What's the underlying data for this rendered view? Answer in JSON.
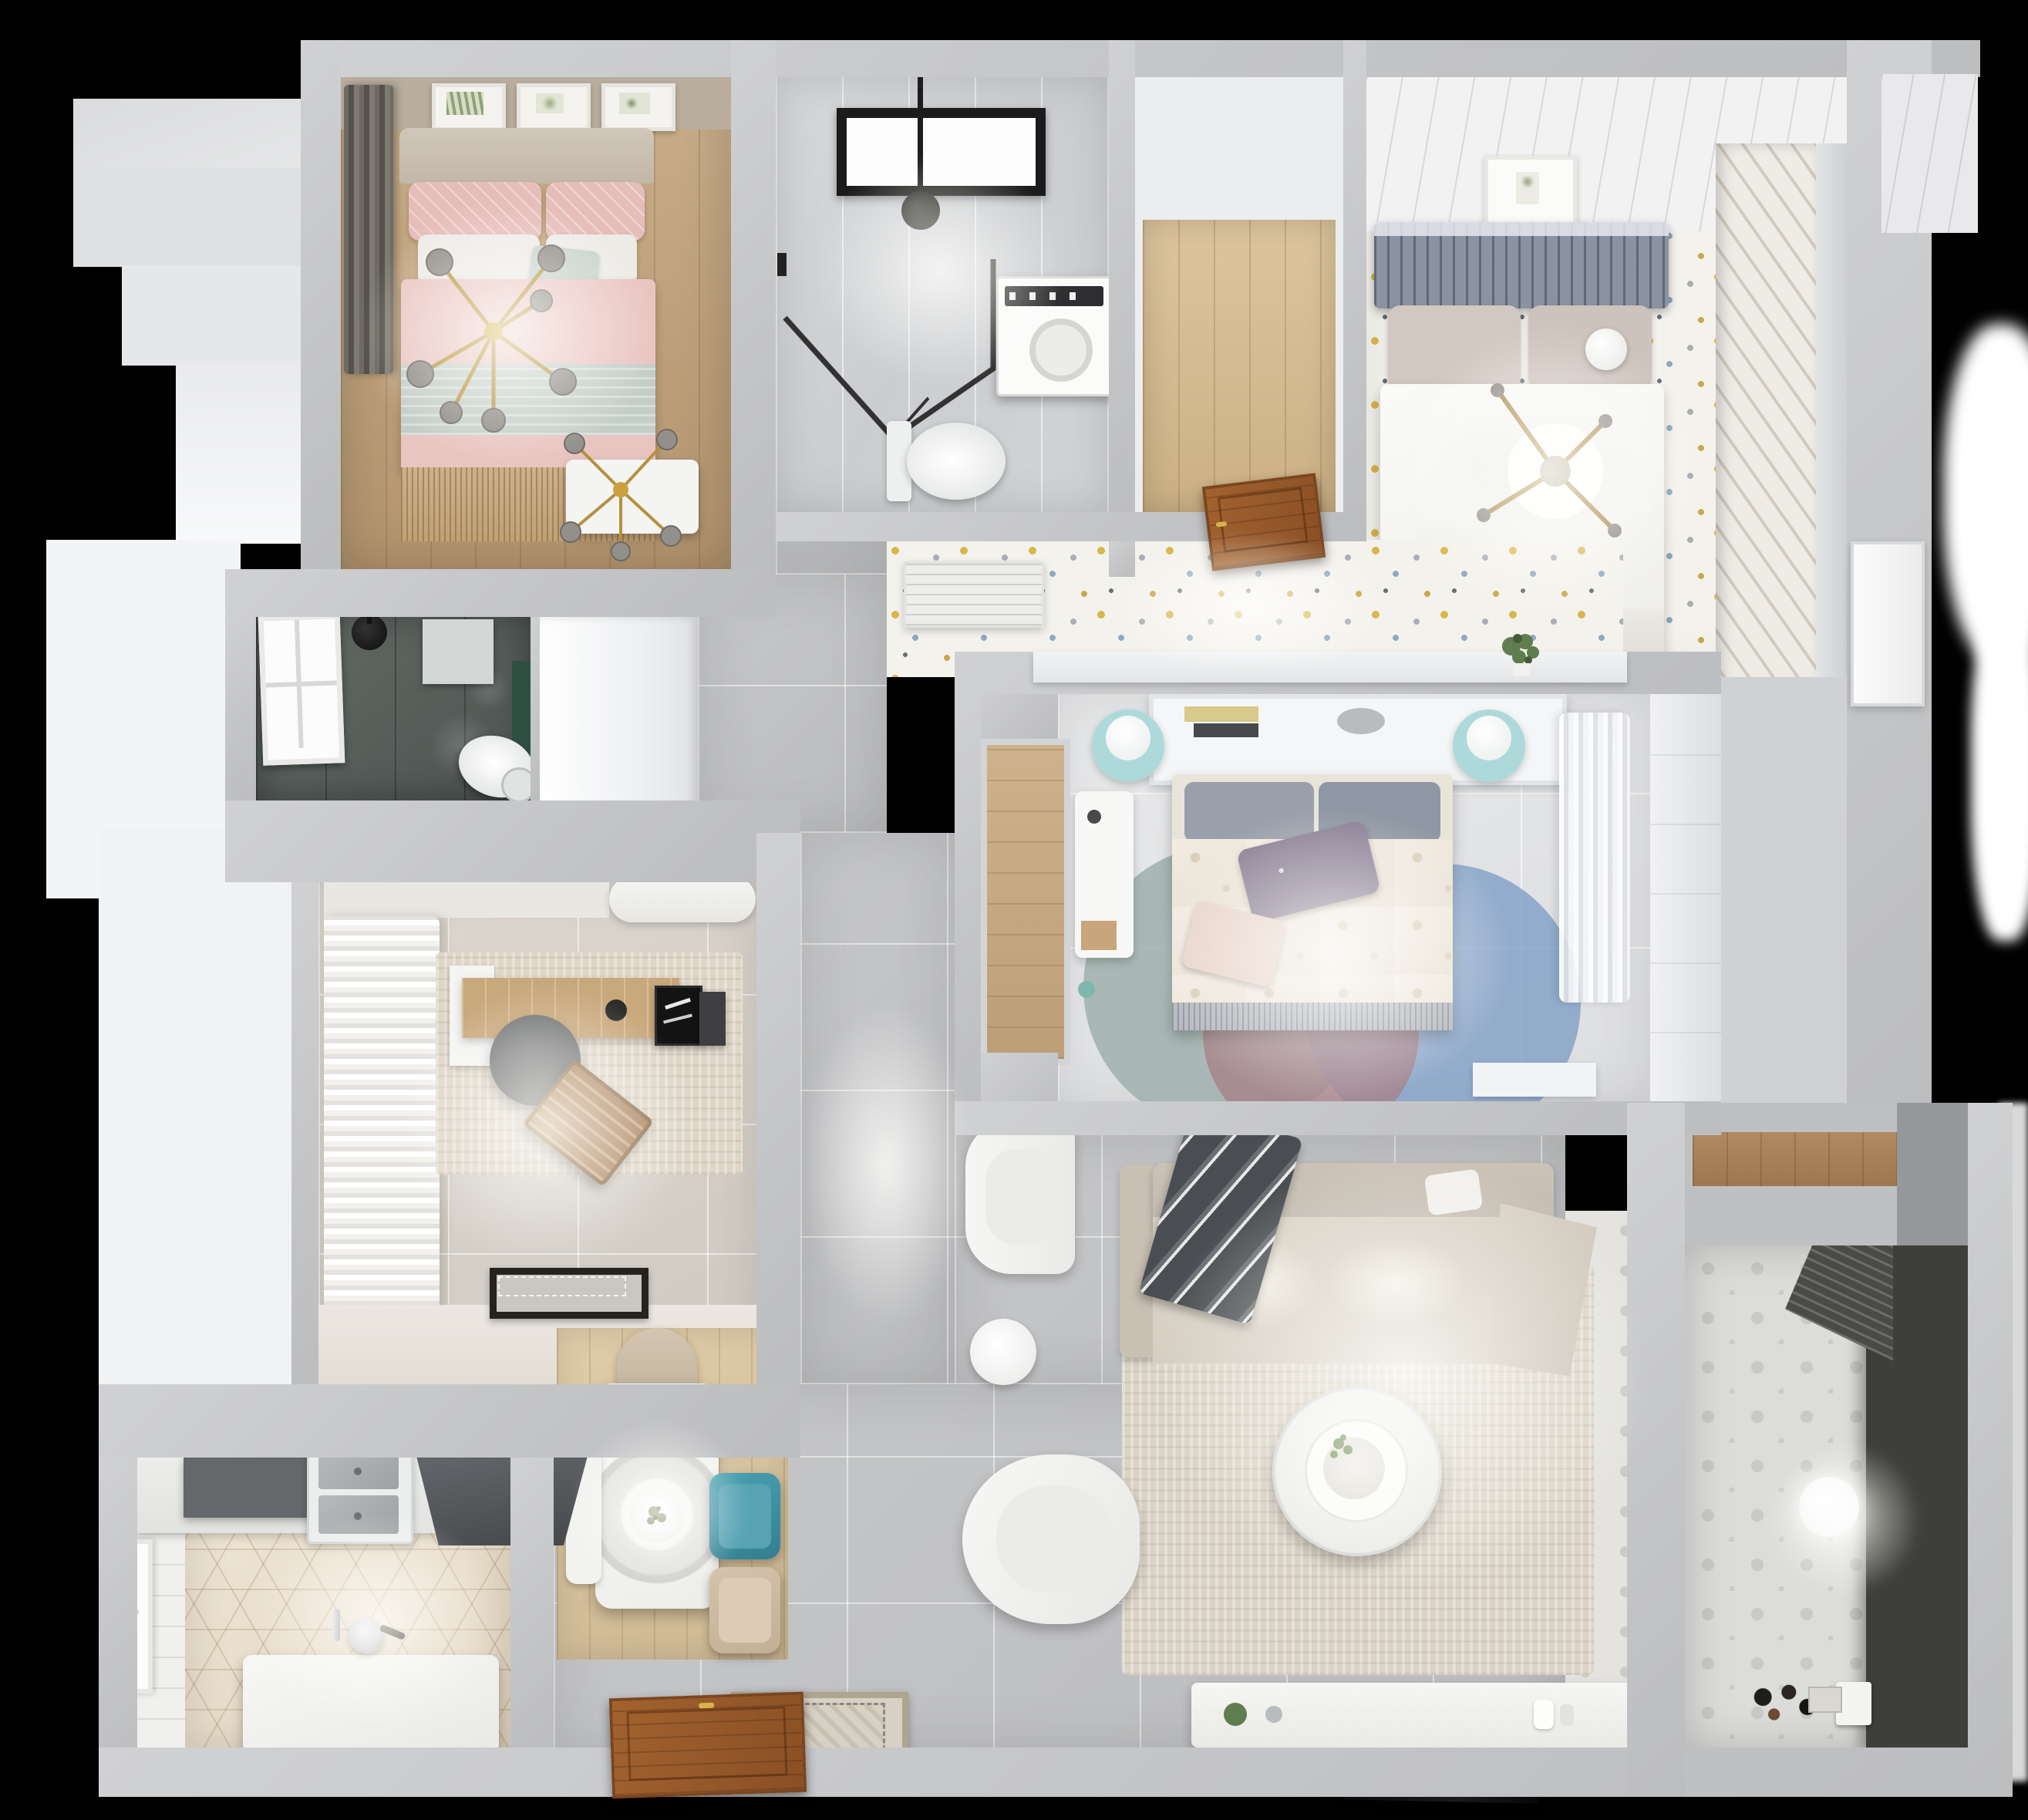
{
  "scene": {
    "label": "Top-down 3D dollhouse render of a furnished apartment floor plan on a black background",
    "background_color": "#000000",
    "wall_color": "#c6c7c9",
    "rooms": {
      "bedroomPink": {
        "label": "Bedroom with pink bed, gold sputnik chandeliers, dark curtain and botanical wall art"
      },
      "bathroomMain": {
        "label": "Main bathroom with window, black-framed walk-in shower, washing machine and toilet"
      },
      "entryCloset": {
        "label": "Entry closet nook with oak plank floor"
      },
      "entryHall": {
        "label": "Entry hall with terrazzo floor, louvered cabinet, wooden front door and console with plant"
      },
      "bedroomGuest": {
        "label": "Guest bedroom with slate headboard bed, white duvet, cross ceiling light and louvered wardrobe"
      },
      "bathroomDark": {
        "label": "Dark-tiled shower room with window, rain shower, toilet and green accent wall"
      },
      "study": {
        "label": "Study with ruffled curtains, desk, office chair, wooden lounge chair, rug and doormat"
      },
      "corridor": {
        "label": "Gray-tiled corridor with built-in white cabinet block and wood wardrobe niche"
      },
      "bedroomMaster": {
        "label": "Master bedroom with headboard shelf, floral duvet bed, purple pillows, aqua lamps, desk, round rug and sheer curtains"
      },
      "living": {
        "label": "Living room with L-shaped sofa, gray throw, armchairs, round coffee table, area rug, TV console and TV"
      },
      "dining": {
        "label": "Dining corner with white table, ring pendant lamp, teal and beige chairs, wood floor and ornate mat"
      },
      "kitchen": {
        "label": "Kitchen with hexagon tile floor, double sink, dark range hood, island bench, kettle and window"
      },
      "balcony": {
        "label": "Balcony laundry with drying rack, pendant ball light, patterned tile floor and storage niche"
      }
    },
    "furniture_labels": {
      "bedPink": "double bed with pink duvet and sage throw",
      "bedGuest": "double bed with white duvet and slate headboard",
      "bedMaster": "double bed with cream floral duvet",
      "sofa": "beige L-shaped sofa",
      "coffeeTable": "round white coffee table",
      "tv": "wall TV panel",
      "diningTable": "white dining table",
      "pendant": "ring pendant lamp",
      "washer": "washing machine",
      "toilet": "toilet",
      "rack": "laundry drying rack",
      "frontDoor": "wooden entry door",
      "sideDoor": "wooden side door",
      "whiteDoor": "white interior door"
    },
    "palette": {
      "pink": "#eac6c2",
      "sage": "#c3cdc6",
      "gold": "#b5913f",
      "slate": "#8b93a1",
      "aqua_lamp": "#aed9da",
      "rug_blue": "#7f9fc7",
      "rug_mauve": "#b497a0",
      "rug_teal": "#9fb0ad",
      "chair_teal": "#3e8fa3",
      "sofa_beige": "#d5cec1",
      "door_brown": "#99592c",
      "floor_wood": "#c3a57f",
      "floor_hex": "#ece3d4",
      "floor_terrazzo": "#f4f2ec",
      "dark_bath": "#5a615d",
      "accent_green": "#6f8f5a"
    }
  }
}
